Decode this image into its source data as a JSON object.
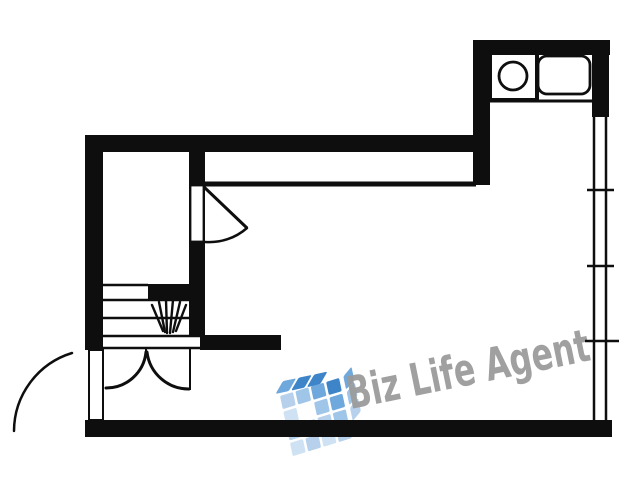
{
  "canvas": {
    "width": 640,
    "height": 480,
    "background": "#ffffff"
  },
  "watermark": {
    "text": "Biz Life Agent",
    "text_color": "#9b9b9b",
    "logo_name": "building-cube-logo",
    "logo_colors": [
      "#3d85c8",
      "#6fa8dc",
      "#9fc5e8",
      "#b7d1ec",
      "#cfe2f3"
    ],
    "logo": {
      "x": 280,
      "y": 396,
      "rotate": -12,
      "tile": 13.5,
      "step": 16,
      "front_grid": [
        [
          3,
          2,
          1,
          0
        ],
        [
          4,
          -1,
          2,
          1
        ],
        [
          3,
          4,
          3,
          2
        ],
        [
          4,
          3,
          4,
          3
        ]
      ],
      "top_row": [
        1,
        0,
        0
      ],
      "side_col": [
        1,
        2,
        3
      ]
    }
  },
  "plan": {
    "ink": "#0e0e0e",
    "paper": "#ffffff",
    "walls": [
      {
        "name": "wall-top",
        "x": 85,
        "y": 135,
        "w": 405,
        "h": 17
      },
      {
        "name": "wall-left",
        "x": 85,
        "y": 135,
        "w": 18,
        "h": 215
      },
      {
        "name": "wall-bottom",
        "x": 85,
        "y": 420,
        "w": 527,
        "h": 17
      },
      {
        "name": "wall-kitchen-top",
        "x": 473,
        "y": 40,
        "w": 137,
        "h": 15
      },
      {
        "name": "wall-kitchen-left",
        "x": 473,
        "y": 40,
        "w": 17,
        "h": 145
      },
      {
        "name": "wall-kitchen-right",
        "x": 592,
        "y": 40,
        "w": 17,
        "h": 77
      },
      {
        "name": "wall-interior-vertical",
        "x": 189,
        "y": 152,
        "w": 16,
        "h": 185
      },
      {
        "name": "wall-mid-horizontal",
        "x": 200,
        "y": 335,
        "w": 81,
        "h": 15
      },
      {
        "name": "wall-stair-stub",
        "x": 148,
        "y": 284,
        "w": 44,
        "h": 16
      }
    ],
    "door_leaves": [
      {
        "name": "interior-door-leaf",
        "x": 190.5,
        "y": 185.5,
        "w": 13,
        "h": 56,
        "sw": 1.8
      },
      {
        "name": "entrance-door-leaf",
        "x": 89,
        "y": 350,
        "w": 14,
        "h": 70,
        "sw": 2
      }
    ],
    "lines": [
      {
        "name": "upper-band-line",
        "x1": 205,
        "y1": 184,
        "x2": 476,
        "y2": 184,
        "w": 5
      },
      {
        "name": "counter-front-line",
        "x1": 489,
        "y1": 101,
        "x2": 592,
        "y2": 101,
        "w": 3
      },
      {
        "name": "stair-tread",
        "x1": 103,
        "y1": 285,
        "x2": 148,
        "y2": 285,
        "w": 2.5
      },
      {
        "name": "stair-tread",
        "x1": 103,
        "y1": 300,
        "x2": 192,
        "y2": 300,
        "w": 2.5
      },
      {
        "name": "stair-tread",
        "x1": 103,
        "y1": 318,
        "x2": 203,
        "y2": 318,
        "w": 2.5
      },
      {
        "name": "stair-tread",
        "x1": 103,
        "y1": 336,
        "x2": 200,
        "y2": 336,
        "w": 2.5
      },
      {
        "name": "door-header-line",
        "x1": 103,
        "y1": 348,
        "x2": 200,
        "y2": 348,
        "w": 2.5
      },
      {
        "name": "door-apex-stub",
        "x1": 146,
        "y1": 347,
        "x2": 146,
        "y2": 353,
        "w": 2
      },
      {
        "name": "door-jamb-line",
        "x1": 190,
        "y1": 348,
        "x2": 190,
        "y2": 390,
        "w": 2
      },
      {
        "name": "window-frame",
        "x1": 594,
        "y1": 117,
        "x2": 594,
        "y2": 420,
        "w": 2.5
      },
      {
        "name": "window-frame",
        "x1": 606,
        "y1": 117,
        "x2": 606,
        "y2": 420,
        "w": 2.5
      },
      {
        "name": "window-tick",
        "x1": 587,
        "y1": 190,
        "x2": 614,
        "y2": 190,
        "w": 2.5
      },
      {
        "name": "window-tick",
        "x1": 587,
        "y1": 266,
        "x2": 614,
        "y2": 266,
        "w": 2.5
      },
      {
        "name": "window-tick",
        "x1": 585,
        "y1": 341,
        "x2": 619,
        "y2": 341,
        "w": 2.5
      },
      {
        "name": "interior-door-open-leaf",
        "x1": 204,
        "y1": 187,
        "x2": 247,
        "y2": 228,
        "w": 3
      }
    ],
    "arcs": [
      {
        "name": "interior-door-swing-arc",
        "d": "M247,228 A57,57 0 0 1 205,242",
        "w": 2.5
      },
      {
        "name": "entrance-door-swing-arc",
        "d": "M72,353 A82,82 0 0 0 14,431",
        "w": 2.5
      },
      {
        "name": "double-door-left-swing-arc",
        "d": "M146,352 A40,40 0 0 1 106,388",
        "w": 3
      },
      {
        "name": "double-door-right-swing-arc",
        "d": "M147,352 A42,42 0 0 0 189,389",
        "w": 3
      }
    ],
    "stair_hatch": [
      {
        "x1": 152,
        "y1": 305,
        "x2": 163,
        "y2": 331
      },
      {
        "x1": 159,
        "y1": 302,
        "x2": 165,
        "y2": 332
      },
      {
        "x1": 166,
        "y1": 300,
        "x2": 167,
        "y2": 333
      },
      {
        "x1": 173,
        "y1": 300,
        "x2": 170,
        "y2": 333
      },
      {
        "x1": 180,
        "y1": 302,
        "x2": 173,
        "y2": 332
      },
      {
        "x1": 186,
        "y1": 305,
        "x2": 176,
        "y2": 331
      }
    ],
    "kitchen": {
      "burner_box": {
        "x": 490,
        "y": 53,
        "w": 47,
        "h": 47,
        "sw": 4
      },
      "burner_circle": {
        "cx": 513,
        "cy": 76,
        "r": 14,
        "sw": 2.8
      },
      "sink": {
        "x": 538,
        "y": 56,
        "w": 52,
        "h": 38,
        "rx": 9,
        "sw": 2.8
      }
    }
  }
}
